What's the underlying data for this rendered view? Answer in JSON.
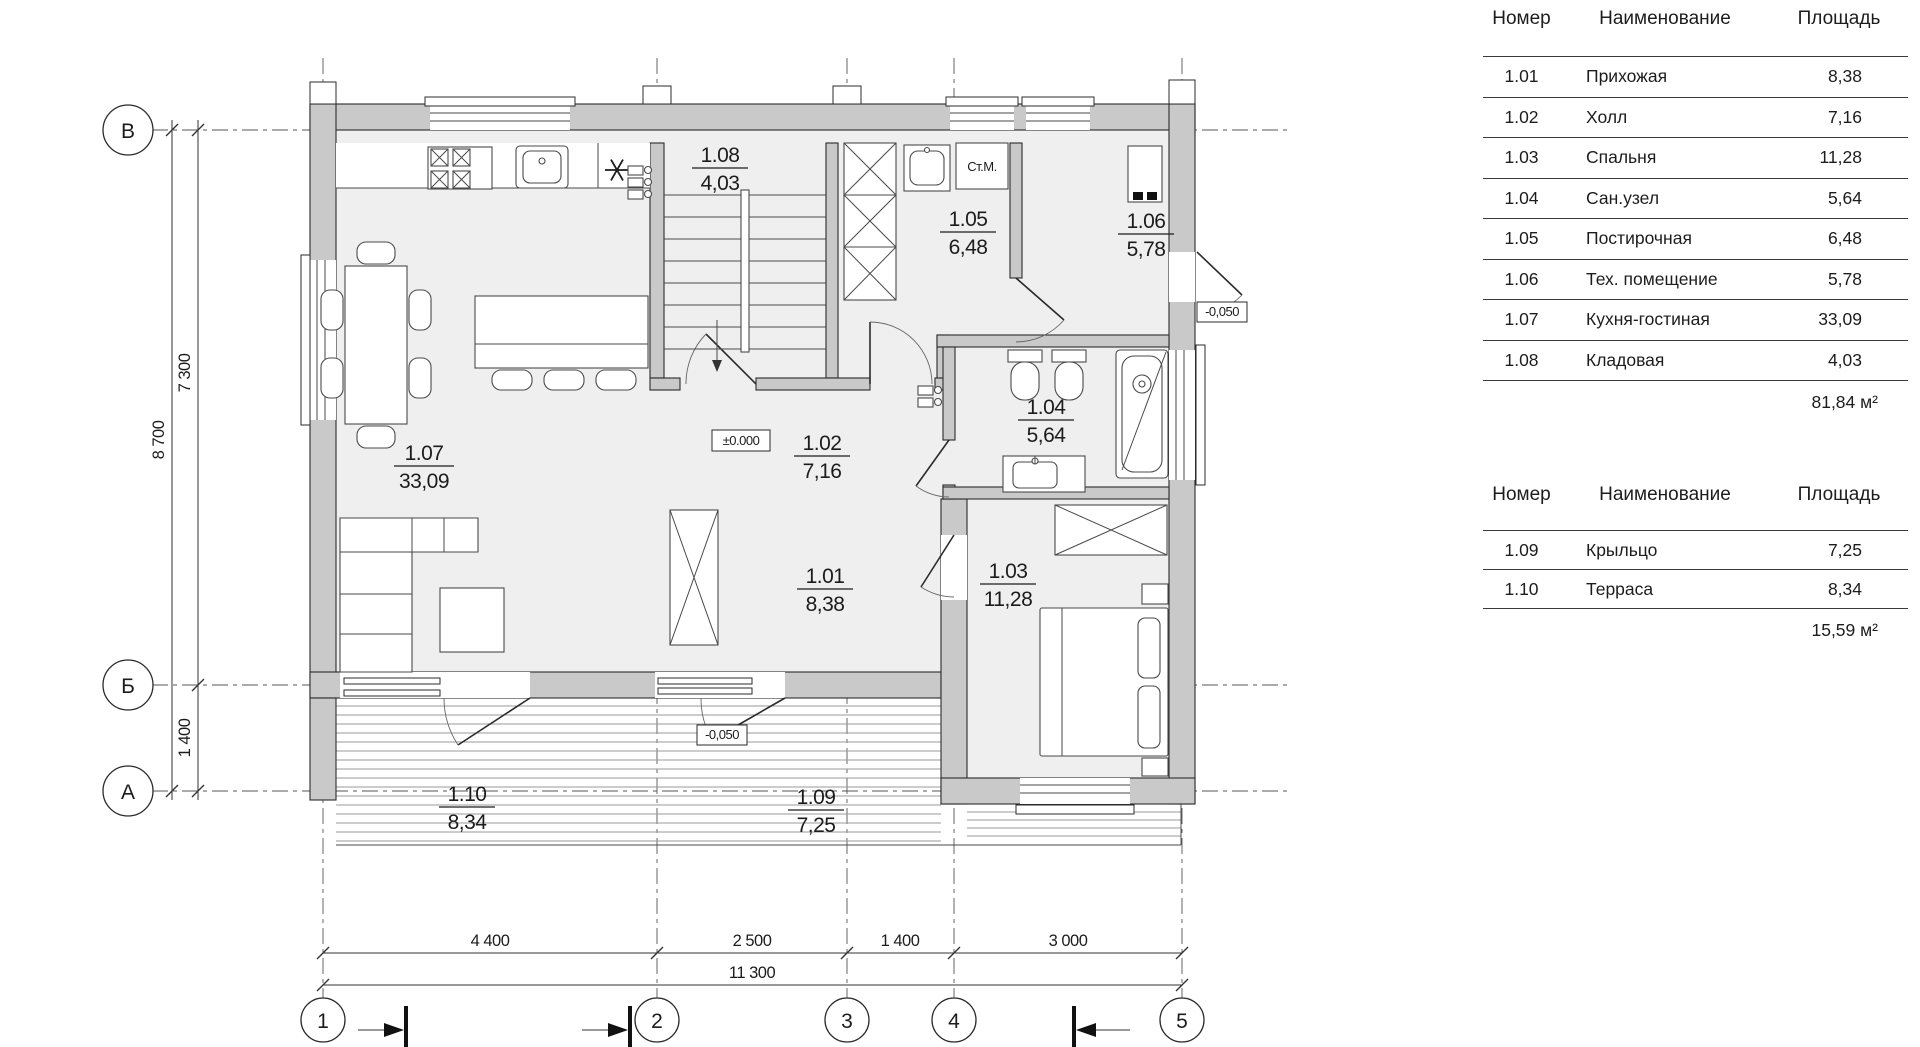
{
  "schedule_headers": {
    "num": "Номер",
    "name": "Наименование",
    "area": "Площадь"
  },
  "schedule1": {
    "rows": [
      {
        "num": "1.01",
        "name": "Прихожая",
        "area": "8,38"
      },
      {
        "num": "1.02",
        "name": "Холл",
        "area": "7,16"
      },
      {
        "num": "1.03",
        "name": "Спальня",
        "area": "11,28"
      },
      {
        "num": "1.04",
        "name": "Сан.узел",
        "area": "5,64"
      },
      {
        "num": "1.05",
        "name": "Постирочная",
        "area": "6,48"
      },
      {
        "num": "1.06",
        "name": "Тех. помещение",
        "area": "5,78"
      },
      {
        "num": "1.07",
        "name": "Кухня-гостиная",
        "area": "33,09"
      },
      {
        "num": "1.08",
        "name": "Кладовая",
        "area": "4,03"
      }
    ],
    "total": "81,84 м²"
  },
  "schedule2": {
    "rows": [
      {
        "num": "1.09",
        "name": "Крыльцо",
        "area": "7,25"
      },
      {
        "num": "1.10",
        "name": "Терраса",
        "area": "8,34"
      }
    ],
    "total": "15,59 м²"
  },
  "plan": {
    "rooms": [
      {
        "num": "1.01",
        "area": "8,38"
      },
      {
        "num": "1.02",
        "area": "7,16"
      },
      {
        "num": "1.03",
        "area": "11,28"
      },
      {
        "num": "1.04",
        "area": "5,64"
      },
      {
        "num": "1.05",
        "area": "6,48"
      },
      {
        "num": "1.06",
        "area": "5,78"
      },
      {
        "num": "1.07",
        "area": "33,09"
      },
      {
        "num": "1.08",
        "area": "4,03"
      },
      {
        "num": "1.09",
        "area": "7,25"
      },
      {
        "num": "1.10",
        "area": "8,34"
      }
    ],
    "labels": {
      "washing_machine": "Ст.М."
    },
    "elevations": {
      "zero": "±0.000",
      "porch": "-0,050",
      "tech_exit": "-0,050"
    },
    "axes": {
      "horizontal": [
        "В",
        "Б",
        "А"
      ],
      "vertical": [
        "1",
        "2",
        "3",
        "4",
        "5"
      ]
    },
    "dimensions": {
      "left_inner_top": "7 300",
      "left_inner_bottom": "1 400",
      "left_outer": "8 700",
      "bottom": [
        "4 400",
        "2 500",
        "1 400",
        "3 000"
      ],
      "bottom_total": "11 300"
    }
  },
  "colors": {
    "wall_fill": "#c9c9c9",
    "floor_fill": "#efefef",
    "line": "#2b2b2b"
  }
}
